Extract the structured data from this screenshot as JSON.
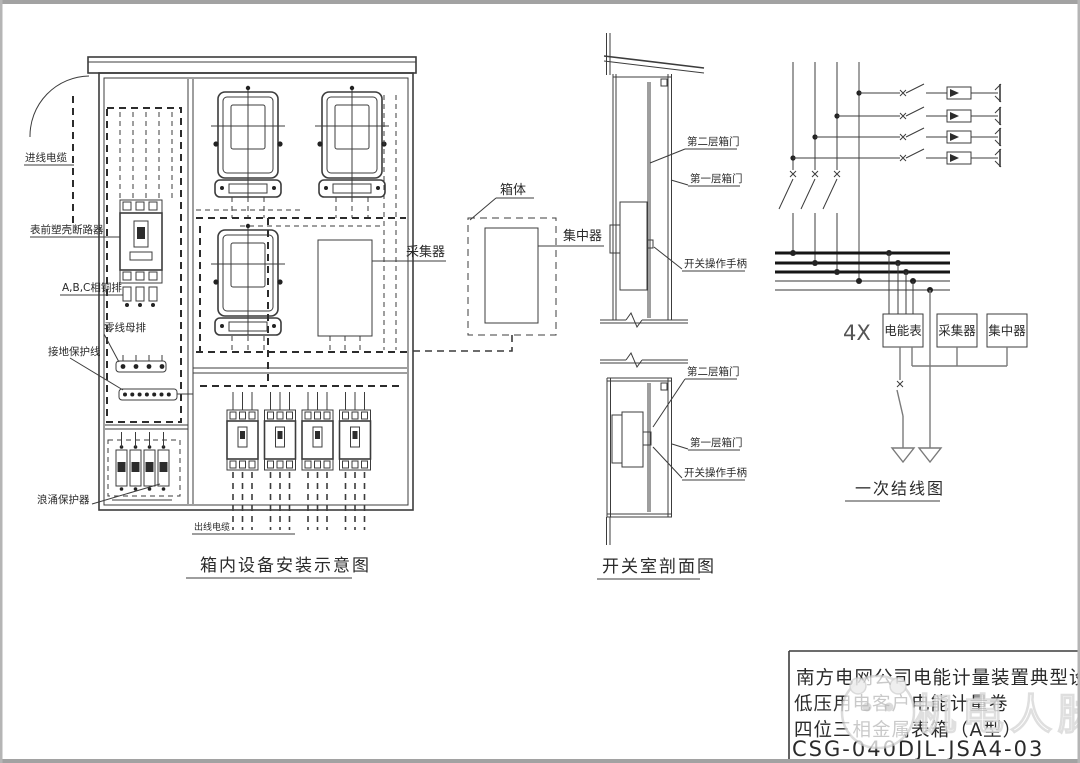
{
  "cabinet": {
    "caption": "箱内设备安装示意图",
    "labels": {
      "incoming_cable": "进线电缆",
      "main_breaker": "表前塑壳断路器",
      "phase_busbar": "A,B,C相铜排",
      "neutral_busbar": "零线母排",
      "ground_wire": "接地保护线",
      "surge_protector": "浪涌保护器",
      "outgoing_cable": "出线电缆",
      "collector": "采集器"
    }
  },
  "concentrator_detail": {
    "box_label": "箱体",
    "concentrator_label": "集中器"
  },
  "switch_room": {
    "caption": "开关室剖面图",
    "upper": {
      "second_door": "第二层箱门",
      "first_door": "第一层箱门",
      "handle": "开关操作手柄"
    },
    "lower": {
      "second_door": "第二层箱门",
      "first_door": "第一层箱门",
      "handle": "开关操作手柄"
    }
  },
  "one_line": {
    "caption": "一次结线图",
    "multiplier": "4X",
    "meter_box": "电能表",
    "collector_box": "采集器",
    "concentrator_box": "集中器"
  },
  "title_block": {
    "line1": "南方电网公司电能计量装置典型设计",
    "line2": "低压用电客户电能计量卷",
    "line3": "四位三相金属表箱（A型）",
    "drawing_no": "CSG-040DJL-JSA4-03"
  },
  "watermark": {
    "text": "机电人脉"
  },
  "colors": {
    "frame": "#a2a2a2",
    "line": "#3c3c3c",
    "bus": "#151515"
  }
}
